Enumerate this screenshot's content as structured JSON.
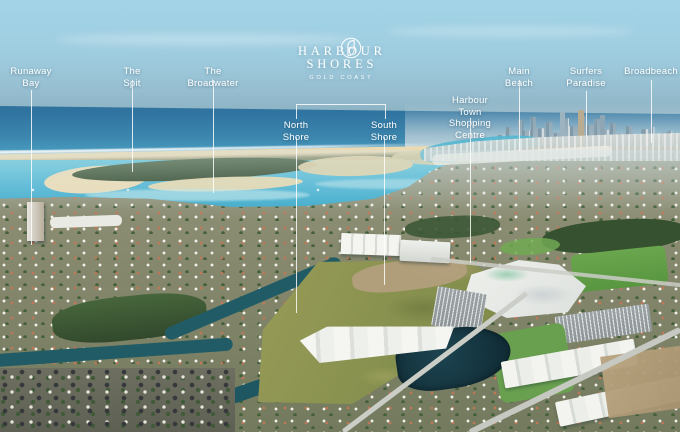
{
  "brand": {
    "monogram": "H",
    "name_line1": "HARBOUR",
    "name_line2": "SHORES",
    "tagline": "GOLD COAST"
  },
  "bracket": {
    "x1": 296,
    "x2": 384,
    "y": 104,
    "stub_height": 14
  },
  "callouts": [
    {
      "id": "runaway-bay",
      "lines": [
        "Runaway",
        "Bay"
      ],
      "x": 31,
      "label_top": 66,
      "segments": [
        {
          "top": 90,
          "bottom": 245
        }
      ]
    },
    {
      "id": "the-spit",
      "lines": [
        "The Spit"
      ],
      "x": 132,
      "label_top": 66,
      "segments": [
        {
          "top": 80,
          "bottom": 172
        }
      ]
    },
    {
      "id": "the-broadwater",
      "lines": [
        "The Broadwater"
      ],
      "x": 213,
      "label_top": 66,
      "segments": [
        {
          "top": 80,
          "bottom": 193
        }
      ]
    },
    {
      "id": "north-shore",
      "lines": [
        "North Shore"
      ],
      "x": 296,
      "label_top": 120,
      "segments": [
        {
          "top": 137,
          "bottom": 313
        }
      ]
    },
    {
      "id": "south-shore",
      "lines": [
        "South Shore"
      ],
      "x": 384,
      "label_top": 120,
      "segments": [
        {
          "top": 137,
          "bottom": 285
        }
      ]
    },
    {
      "id": "harbour-town-shopping-centre",
      "lines": [
        "Harbour Town",
        "Shopping Centre"
      ],
      "x": 470,
      "label_top": 95,
      "segments": [
        {
          "top": 118,
          "bottom": 263
        }
      ]
    },
    {
      "id": "main-beach",
      "lines": [
        "Main Beach"
      ],
      "x": 519,
      "label_top": 66,
      "segments": [
        {
          "top": 80,
          "bottom": 151
        }
      ]
    },
    {
      "id": "surfers-paradise",
      "lines": [
        "Surfers",
        "Paradise"
      ],
      "x": 586,
      "label_top": 66,
      "segments": [
        {
          "top": 91,
          "bottom": 136
        }
      ]
    },
    {
      "id": "broadbeach",
      "lines": [
        "Broadbeach"
      ],
      "x": 651,
      "label_top": 66,
      "segments": [
        {
          "top": 80,
          "bottom": 143
        }
      ]
    }
  ],
  "colors": {
    "label_text": "#ffffff",
    "leader_line": "#ffffff",
    "sky_top": "#a2d4e7",
    "sky_horizon": "#7ea5b6",
    "ocean_deep": "#2f74a0",
    "ocean_shallow": "#53b0cd",
    "broadwater": "#4fb6d4",
    "sand": "#ecdcb6",
    "spit_vegetation": "#3f5538",
    "suburb_base": "#8a8c72",
    "field_green": "#8b9150",
    "canal": "#215c66",
    "lake": "#122f39",
    "roof_white": "#f2f2ee",
    "roof_terracotta": "#b4684a",
    "tree_green": "#35512f"
  }
}
